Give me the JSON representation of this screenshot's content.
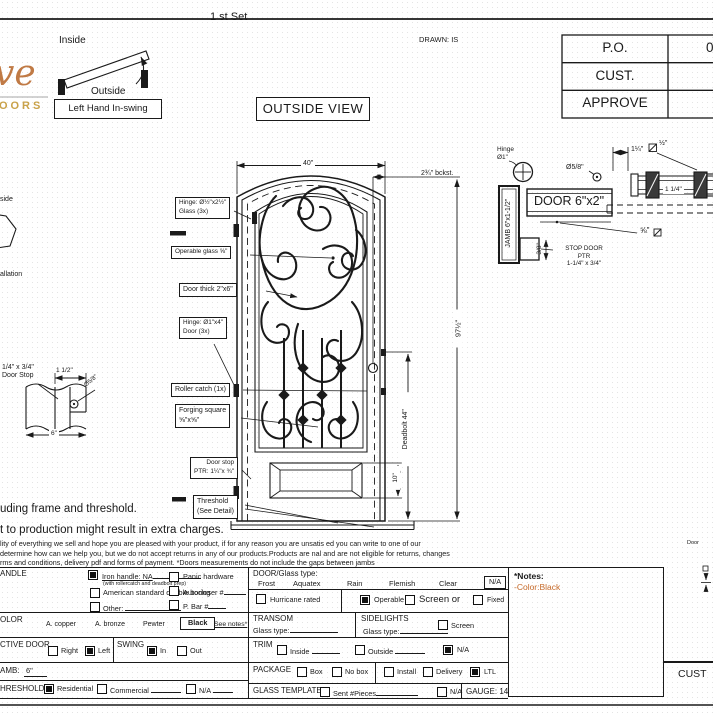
{
  "page": {
    "top_set": "1 st Set",
    "drawn": "DRAWN: IS",
    "outside_view": "OUTSIDE VIEW"
  },
  "logo": {
    "script": "ve",
    "word": "DOORS"
  },
  "swing": {
    "inside": "Inside",
    "outside": "Outside",
    "caption": "Left Hand In-swing"
  },
  "po_table": {
    "rows": [
      "P.O.",
      "CUST.",
      "APPROVE"
    ],
    "po_value": "0"
  },
  "door": {
    "dim_width": "40\"",
    "dim_backset": "2¾\" bckst.",
    "dim_height": "97½\"",
    "dim_deadbolt": "Deadbolt 44\"",
    "dim_panel": "10\"",
    "lbl_hinge_glass1": "Hinge: Ø½\"x2½\"",
    "lbl_hinge_glass2": "Glass (3x)",
    "lbl_operable": "Operable glass ⅝\"",
    "lbl_thick": "Door thick 2\"x6\"",
    "lbl_hinge_door1": "Hinge: Ø1\"x4\"",
    "lbl_hinge_door2": "Door (3x)",
    "lbl_roller": "Roller catch (1x)",
    "lbl_forging1": "Forging square",
    "lbl_forging2": "⅝\"x⅝\"",
    "lbl_stop1": "Door stop",
    "lbl_stop2": "PTR: 1¼\"x ¾\"",
    "lbl_thresh1": "Threshold",
    "lbl_thresh2": "(See Detail)"
  },
  "jamb": {
    "hinge1": "Hinge",
    "hinge2": "Ø1\"",
    "dia58": "Ø5/8\"",
    "door_size": "DOOR 6\"x2\"",
    "jamb_size": "JAMB 6\"x1-1/2\"",
    "dim38": "3/8\"",
    "stop1": "STOP DOOR",
    "stop2": "PTR",
    "stop3": "1-1/4\" x 3/4\"",
    "dim114": "1¼\"",
    "sq_half": "½\"",
    "glass114": "1 1/4\"",
    "f58": "⅝\""
  },
  "stop_detail": {
    "l1": "1/4\" x 3/4\"",
    "l2": "Door Stop",
    "d112": "1 1/2\"",
    "d58": "Ø5/8\"",
    "d6": "6\""
  },
  "partials": {
    "p1": "side",
    "p2": "allation",
    "door_note": "Door",
    "cust": "CUST"
  },
  "paragraph": {
    "b1": "uding frame and threshold.",
    "b2": "t to production might result in extra charges.",
    "s1": "lity of everything we sell and hope you are pleased with your product, if for any reason you are unsatis ed you can write to one of our",
    "s2": "determine how can we help you, but we do not accept returns in any of our products.Products are nal and are not eligible for returns, changes",
    "s3": "rms and conditions, delivery pdf and forms of payment. *Doors measurements do not include the gaps between jambs"
  },
  "form": {
    "handle": {
      "label": "ANDLE",
      "iron": {
        "label": "Iron handle: NA",
        "checked": true
      },
      "iron_sub": "(with rollercatch and deadbolt prep)",
      "american": {
        "label": "American standard double boring",
        "checked": false
      },
      "other": {
        "label": "Other:",
        "checked": false
      },
      "panic": {
        "label": "Panic hardware",
        "checked": false
      },
      "autocloser": {
        "label": "Autocloser #",
        "checked": false
      },
      "pbar": {
        "label": "P. Bar #",
        "checked": false
      }
    },
    "color": {
      "label": "OLOR",
      "opts": [
        "A. copper",
        "A. bronze",
        "Pewter"
      ],
      "selected": "Black",
      "see_notes": "See notes*"
    },
    "active": {
      "label": "CTIVE DOOR",
      "right": {
        "label": "Right",
        "checked": false
      },
      "left": {
        "label": "Left",
        "checked": true
      }
    },
    "swing": {
      "label": "SWING",
      "in": {
        "label": "In",
        "checked": true
      },
      "out": {
        "label": "Out",
        "checked": false
      }
    },
    "jamb": {
      "label": "AMB:",
      "value": "6\""
    },
    "threshold": {
      "label": "HRESHOLD",
      "residential": {
        "label": "Residential",
        "checked": true
      },
      "commercial": {
        "label": "Commercial",
        "checked": false
      },
      "na": {
        "label": "N/A",
        "checked": false
      }
    },
    "glass": {
      "label": "DOOR/Glass type:",
      "opts": [
        "Frost",
        "Aquatex",
        "Rain",
        "Flemish",
        "Clear"
      ],
      "na": "N/A"
    },
    "hurricane": {
      "label": "Hurricane rated",
      "checked": false
    },
    "operable": {
      "label": "Operable",
      "checked": true
    },
    "screen_or": {
      "label": "Screen or",
      "checked": false
    },
    "fixed": {
      "label": "Fixed",
      "checked": false
    },
    "transom": {
      "label": "TRANSOM",
      "glass": "Glass type:"
    },
    "sidelights": {
      "label": "SIDELIGHTS",
      "glass": "Glass type:",
      "screen": {
        "label": "Screen",
        "checked": false
      }
    },
    "trim": {
      "label": "TRIM",
      "inside": {
        "label": "Inside",
        "checked": false
      },
      "outside": {
        "label": "Outside",
        "checked": false
      },
      "na": {
        "label": "N/A",
        "checked": true
      }
    },
    "package": {
      "label": "PACKAGE",
      "box": {
        "label": "Box",
        "checked": false
      },
      "nobox": {
        "label": "No box",
        "checked": false
      },
      "install": {
        "label": "Install",
        "checked": false
      },
      "delivery": {
        "label": "Delivery",
        "checked": false
      },
      "ltl": {
        "label": "LTL",
        "checked": true
      }
    },
    "template": {
      "label": "GLASS TEMPLATE",
      "sent": {
        "label": "Sent #Pieces",
        "checked": false
      },
      "na": {
        "label": "N/A",
        "checked": false
      },
      "gauge": "GAUGE: 14"
    },
    "notes": {
      "title": "*Notes:",
      "body": "-Color:Black"
    }
  },
  "colors": {
    "note_accent": "#c66a2a",
    "logo_script": "#c07a45",
    "logo_word": "#c9a24a",
    "ink": "#1a1a1a"
  }
}
